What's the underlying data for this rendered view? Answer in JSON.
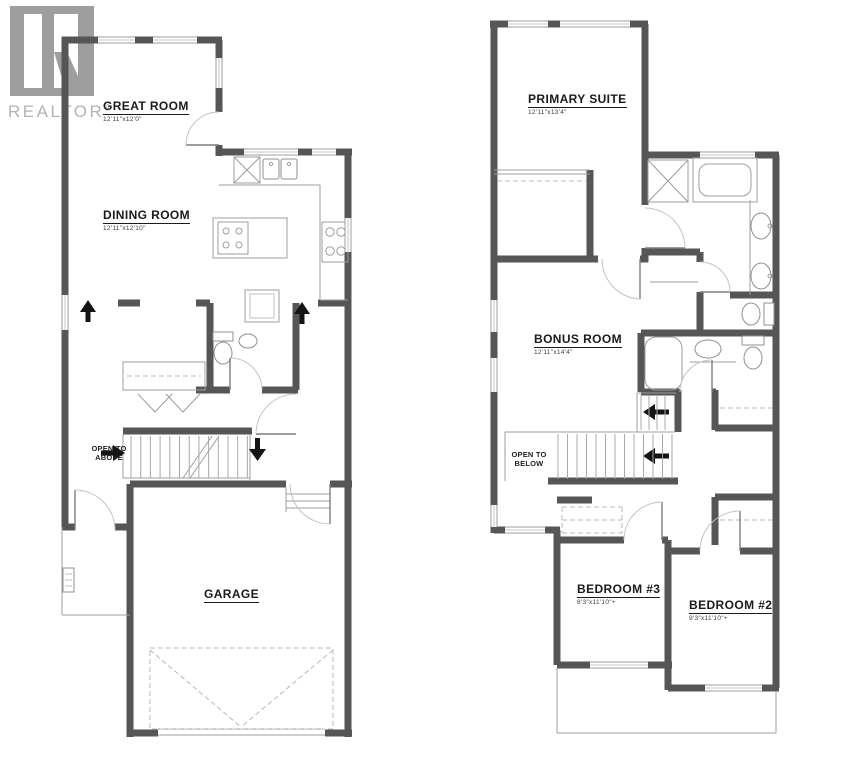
{
  "watermark": {
    "brand": "REALTOR",
    "registered": "®"
  },
  "plans": {
    "main_floor": {
      "rooms": {
        "great_room": {
          "name": "GREAT ROOM",
          "dims": "12'11\"x12'0\""
        },
        "dining_room": {
          "name": "DINING ROOM",
          "dims": "12'11\"x12'10\""
        },
        "garage": {
          "name": "GARAGE",
          "dims": ""
        }
      },
      "notes": {
        "open_to_above": {
          "line1": "OPEN TO",
          "line2": "ABOVE"
        }
      }
    },
    "upper_floor": {
      "rooms": {
        "primary_suite": {
          "name": "PRIMARY SUITE",
          "dims": "12'11\"x13'4\""
        },
        "bonus_room": {
          "name": "BONUS ROOM",
          "dims": "12'11\"x14'4\""
        },
        "bedroom_3": {
          "name": "BEDROOM #3",
          "dims": "8'3\"x11'10\"+"
        },
        "bedroom_2": {
          "name": "BEDROOM #2",
          "dims": "9'3\"x11'10\"+"
        }
      },
      "notes": {
        "open_to_below": {
          "line1": "OPEN TO",
          "line2": "BELOW"
        }
      }
    }
  },
  "colors": {
    "wall": "#565656",
    "thin_line": "#9d9d9d",
    "dashed_line": "#b8b8b8",
    "watermark_gray": "#a6a6a6",
    "label_text": "#1a1a1a",
    "arrow": "#151515",
    "background": "#ffffff"
  }
}
